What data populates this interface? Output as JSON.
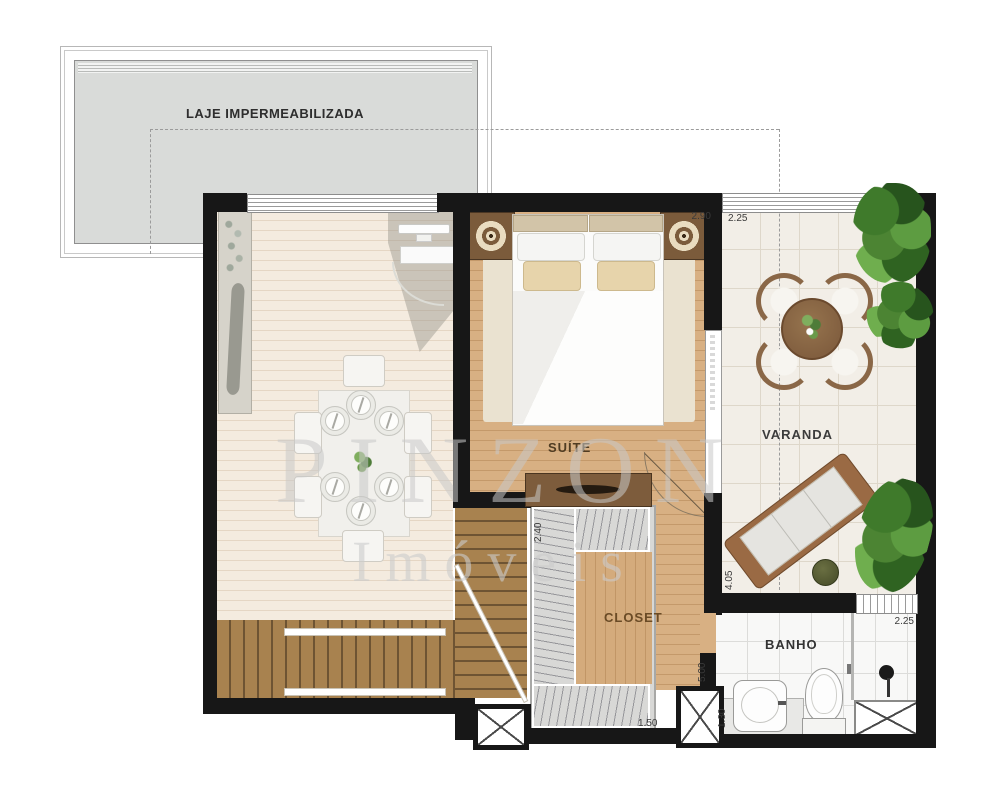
{
  "rooms": {
    "laje": {
      "label": "LAJE IMPERMEABILIZADA"
    },
    "suite": {
      "label": "SUÍTE",
      "dim_width": "2.90"
    },
    "varanda": {
      "label": "VARANDA",
      "dim_width": "2.25",
      "dim_height": "4.05"
    },
    "closet": {
      "label": "CLOSET",
      "dim_top": "2.40",
      "dim_bottom": "1.50",
      "dim_right": "5.00"
    },
    "banho": {
      "label": "BANHO",
      "dim_width": "2.25",
      "dim_height": "1.30"
    }
  },
  "watermark": {
    "brand": "PINZON",
    "tagline": "Imóveis"
  },
  "colors": {
    "wall": "#171717",
    "slab_gray": "#d9dbd9",
    "suite_wood": "#d8b083",
    "stair_wood": "#a8824f",
    "living_floor": "#f4ebdf",
    "varanda_tile": "#f2eee7",
    "banho_tile": "#f8f8f7",
    "plant_green": "#4c8433",
    "table_wood": "#8a6747"
  }
}
